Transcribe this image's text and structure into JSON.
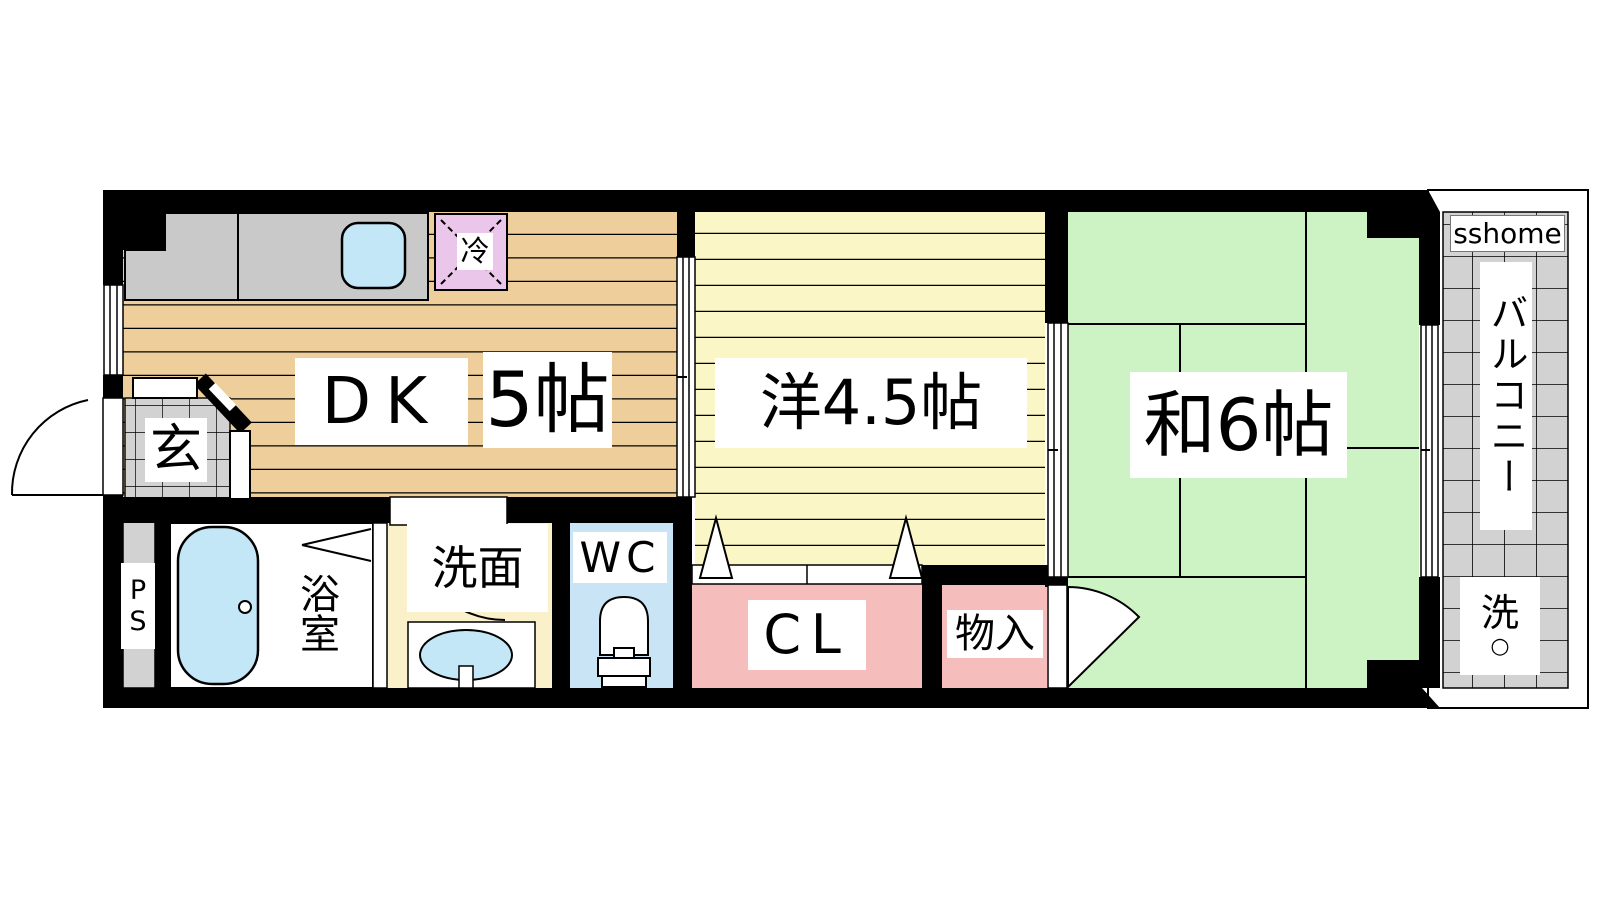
{
  "floorplan": {
    "watermark": "sshome",
    "rooms": {
      "dk": {
        "name": "DK",
        "size": "5帖"
      },
      "western": {
        "name": "洋4.5帖"
      },
      "japanese": {
        "name": "和6帖"
      },
      "entrance": {
        "name": "玄"
      },
      "pipe_space": {
        "name": "PS"
      },
      "bathroom": {
        "name": "浴室"
      },
      "washroom": {
        "name": "洗面"
      },
      "wc": {
        "name": "WC"
      },
      "closet": {
        "name": "CL"
      },
      "storage": {
        "name": "物入"
      },
      "balcony": {
        "name": "バルコニー"
      },
      "refrigerator": {
        "name": "冷"
      },
      "washer": {
        "name": "洗",
        "mark": "○"
      }
    },
    "colors": {
      "wall": "#000000",
      "dk_floor": "#eecf9b",
      "western_floor": "#faf6c5",
      "tatami": "#cdf3c4",
      "closet_pink": "#f6bdbd",
      "wc_blue": "#c9e4f4",
      "washroom_yellow": "#faf0ca",
      "fixture_blue": "#c3e7f7",
      "refrigerator_purple": "#eac6ea",
      "tile_gray": "#d2d2d2",
      "counter_gray": "#c9c9c9"
    }
  }
}
